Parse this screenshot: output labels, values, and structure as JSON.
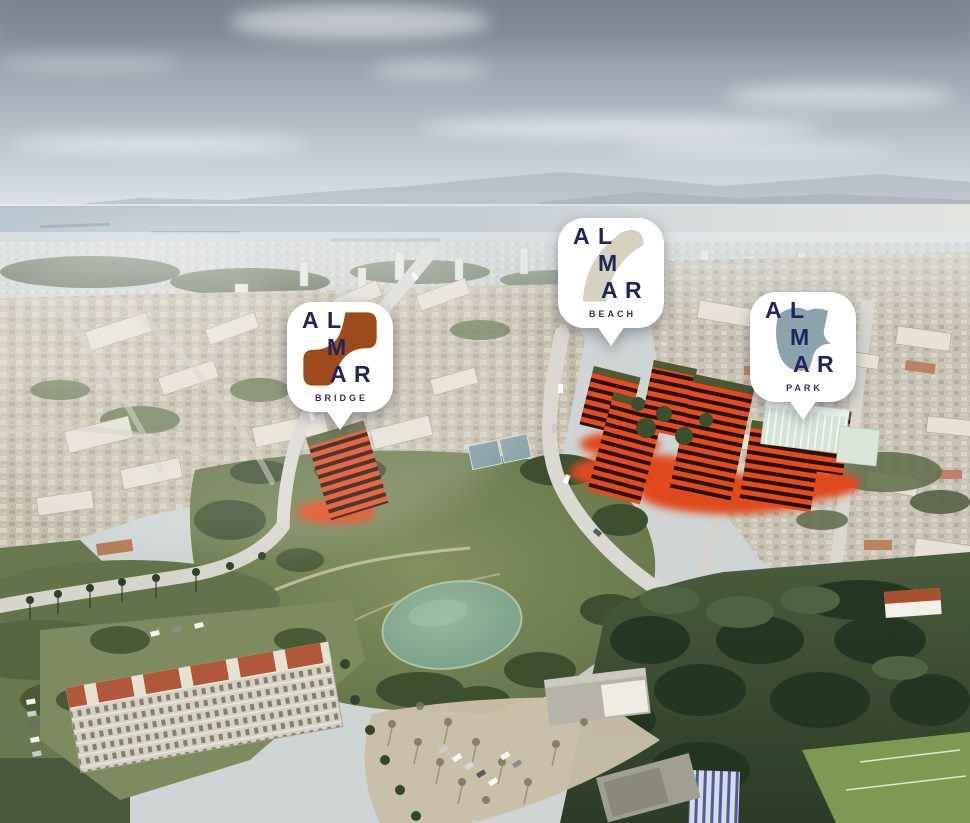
{
  "logo_letters": [
    "A",
    "L",
    "M",
    "A",
    "R"
  ],
  "letter_color": "#20265a",
  "label_color": "#2a3161",
  "markers": [
    {
      "id": "bridge",
      "label": "BRIDGE",
      "logo_color": "#9d4b1d"
    },
    {
      "id": "beach",
      "label": "BEACH",
      "logo_color": "#d7d1bf"
    },
    {
      "id": "park",
      "label": "PARK",
      "logo_color": "#8aa3ac"
    }
  ],
  "scene_colors": {
    "sky_top": "#7e8792",
    "sky_horizon": "#eef0ee",
    "water": "#b4c1cb",
    "mountains": "#aab3bd",
    "city_beige": "#c6bfae",
    "park_green": "#6d7d50",
    "pond_green": "#7fa88e",
    "development_red": "#e8491d",
    "development_dark": "#231309",
    "mint_building": "#d5e4d8",
    "woods_dark": "#2b3b26",
    "road_gray": "#d6d5cd",
    "marker_background": "#ffffff"
  }
}
